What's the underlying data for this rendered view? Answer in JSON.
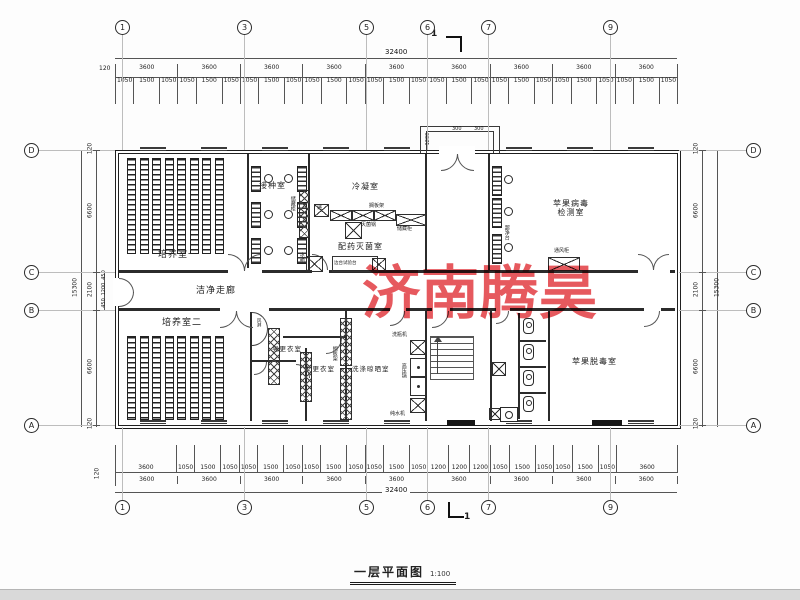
{
  "page": {
    "title_text": "一层平面图",
    "title_scale": "1:100",
    "watermark": "济南腾昊",
    "section_mark": "1"
  },
  "grid": {
    "top": [
      "1",
      "3",
      "5",
      "6",
      "7",
      "9"
    ],
    "bottom": [
      "1",
      "3",
      "5",
      "6",
      "7",
      "9"
    ],
    "left": [
      "D",
      "C",
      "B",
      "A"
    ],
    "right": [
      "D",
      "C",
      "B",
      "A"
    ]
  },
  "dims": {
    "top_overall": "32400",
    "top_lead": "120",
    "top_bays": [
      "3600",
      "3600",
      "3600",
      "3600",
      "3600",
      "3600",
      "3600",
      "3600",
      "3600"
    ],
    "top_windows": [
      "1050",
      "1500",
      "1050",
      "1050",
      "1500",
      "1050",
      "1050",
      "1500",
      "1050",
      "1050",
      "1500",
      "1050",
      "1050",
      "1500",
      "1050",
      "1050",
      "1500",
      "1050",
      "1050",
      "1500",
      "1050",
      "1050",
      "1500",
      "1050",
      "1050",
      "1500",
      "1050"
    ],
    "bottom_windows": [
      "3600",
      "1050",
      "1500",
      "1050",
      "1050",
      "1500",
      "1050",
      "1050",
      "1500",
      "1050",
      "1050",
      "1500",
      "1050",
      "1200",
      "1200",
      "1200",
      "1050",
      "1500",
      "1050",
      "1050",
      "1500",
      "1050",
      "3600"
    ],
    "bottom_bays": [
      "3600",
      "3600",
      "3600",
      "3600",
      "3600",
      "3600",
      "3600",
      "3600",
      "3600"
    ],
    "bottom_lead": "120",
    "bottom_overall": "32400",
    "left": {
      "segs": [
        "120",
        "6600",
        "2100",
        "6600",
        "120"
      ],
      "sub": [
        "450",
        "1200",
        "450"
      ],
      "overall": "15300"
    },
    "right": {
      "segs": [
        "120",
        "6600",
        "2100",
        "6600",
        "120"
      ],
      "overall": "15300"
    },
    "entrance": [
      "1200",
      "300",
      "300"
    ]
  },
  "rooms": {
    "culture1": "培养室一",
    "inoculation": "接种室",
    "condensing": "冷凝室",
    "dispensing": "配药灭菌室",
    "virus_test": "苹果病毒检测室",
    "corridor": "洁净走廊",
    "culture2": "培养室二",
    "men_change": "男更衣室",
    "women_change": "女更衣室",
    "washing": "洗涤晾晒室",
    "detox": "苹果脱毒室"
  },
  "equipment": {
    "clean_bench": "超净台",
    "fume_hood": "通风柜",
    "sterilizer": "灭菌锅",
    "storage": "储藏柜",
    "side_bench": "边台试验台",
    "fridge": "冰箱",
    "pass_box": "递",
    "air_shower": "风淋",
    "shelf": "搁板架",
    "bottle_washer": "洗瓶机",
    "autoclave": "高压锅",
    "water_purifier": "纯水机"
  }
}
